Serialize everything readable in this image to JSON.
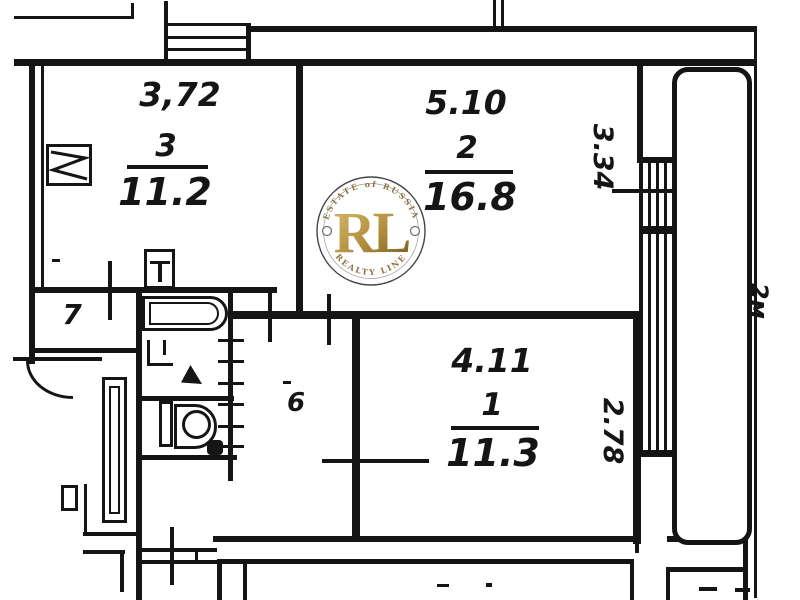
{
  "rooms": {
    "room3": {
      "number": "3",
      "area": "11.2",
      "top_dim": "3,72"
    },
    "room2": {
      "number": "2",
      "area": "16.8",
      "top_dim": "5.10",
      "side_dim": "3.34"
    },
    "room1": {
      "number": "1",
      "area": "11.3",
      "top_dim": "4.11",
      "side_dim": "2.78"
    },
    "hallway": {
      "number": "6"
    },
    "storage": {
      "number": "7"
    }
  },
  "balcony": {
    "width_dim": "2м"
  },
  "watermark": {
    "monogram": "RL",
    "top_arc": "ESTATE of RUSSIA",
    "bottom_arc": "REALTY LINE"
  },
  "colors": {
    "ink": "#151515",
    "paper": "#ffffff",
    "gold_light": "#d8bc6d",
    "gold_dark": "#7c5d24",
    "ring": "#454545",
    "arc_text": "#8d7544"
  }
}
